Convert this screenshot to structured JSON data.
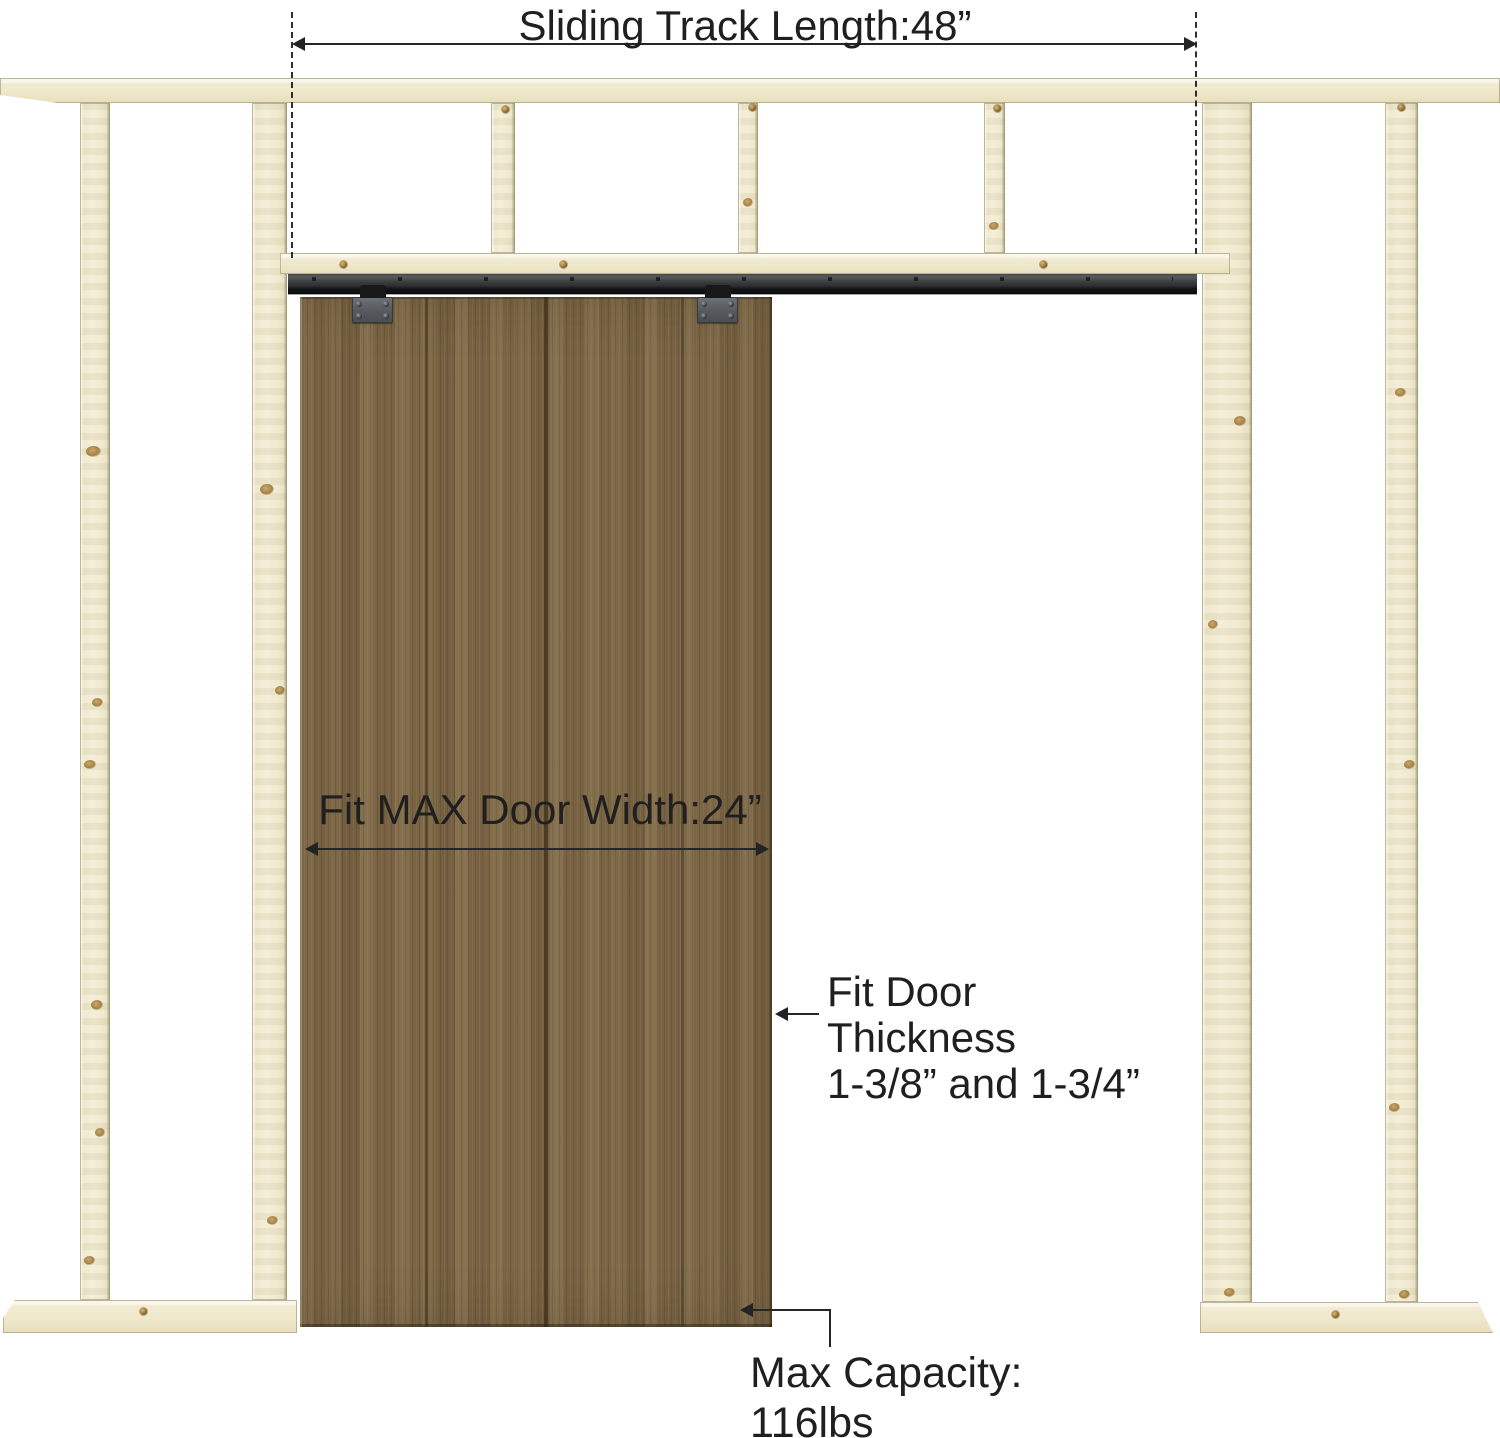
{
  "diagram": {
    "type": "sliding-door-hardware-dimension-diagram",
    "annotations": {
      "track_length": "Sliding Track Length:48”",
      "door_width": "Fit MAX Door Width:24”",
      "door_thickness": [
        "Fit Door",
        "Thickness",
        "1-3/8” and 1-3/4”"
      ],
      "max_capacity": [
        "Max Capacity:",
        "116lbs"
      ]
    },
    "colors": {
      "background": "#ffffff",
      "frame_wood": "#f0e9cd",
      "door_wood": "#7d6847",
      "track": "#333538",
      "hanger": "#5c6166",
      "annotation_text": "#1f1f1f"
    }
  }
}
